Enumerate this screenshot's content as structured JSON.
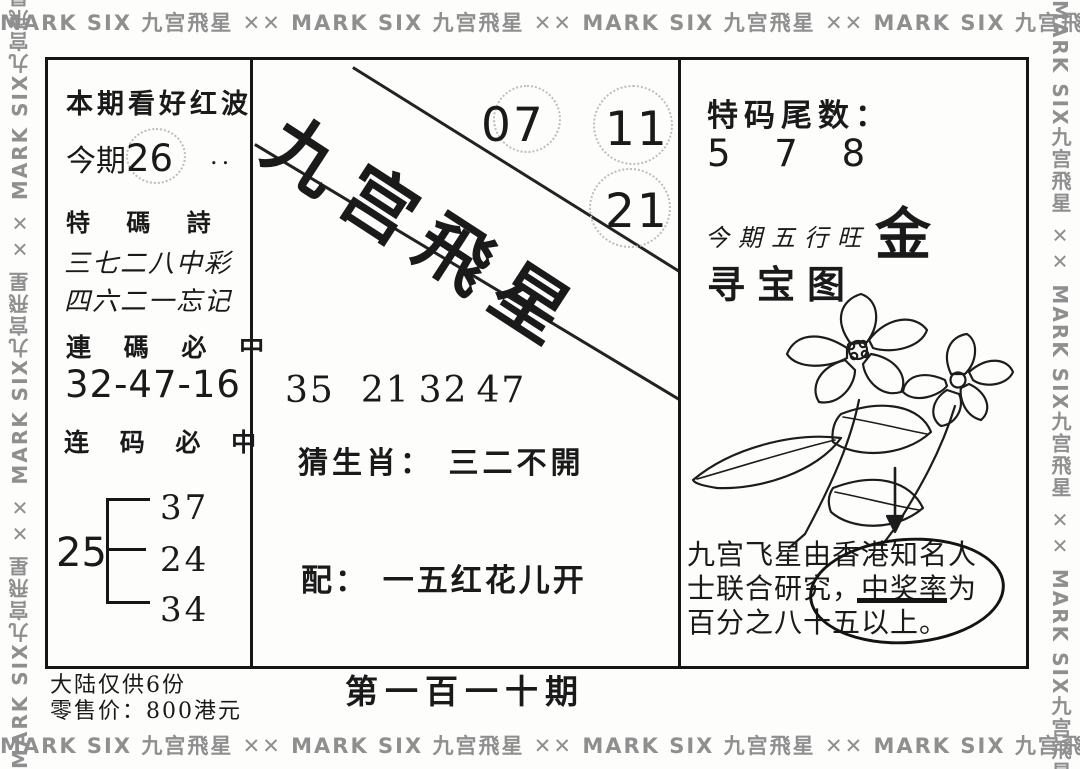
{
  "border": {
    "strip_h": "MARK SIX 九宫飛星 ✕✕ MARK SIX 九宫飛星 ✕✕ MARK SIX 九宫飛星 ✕✕ MARK SIX 九宫飛星 ✕✕",
    "strip_v": "MARK SIX九宫飛星 ✕✕ MARK SIX九宫飛星 ✕✕ MARK SIX九宫飛星 ✕✕",
    "stamp_color": "#8f8f8f"
  },
  "left_column": {
    "headline": "本期看好红波",
    "period_label": "今期",
    "period_number": "26",
    "period_dots": "..",
    "poem_title": "特 碼 詩",
    "poem_line1": "三七二八中彩",
    "poem_line2": "四六二一忘记",
    "lianma_label_trad": "連 碼 必 中",
    "lianma_numbers": "32-47-16",
    "lianma_label_simp": "连 码 必 中",
    "bracket": {
      "root": "25",
      "leaves": [
        "37",
        "24",
        "34"
      ]
    }
  },
  "middle_column": {
    "brand_calligraphy": "九宫飛星",
    "circled_numbers": [
      "07",
      "11",
      "21"
    ],
    "number_row": [
      "35",
      "21",
      "32",
      "47"
    ],
    "zodiac_label": "猜生肖：",
    "zodiac_value": "三二不開",
    "pair_label": "配：",
    "pair_value": "一五红花儿开"
  },
  "right_column": {
    "tail_label": "特码尾数：",
    "tail_numbers": "5 7 8",
    "wuxing_label": "今期五行旺",
    "wuxing_value": "金",
    "treasure_title": "寻宝图",
    "note_line1": "九宫飞星由香港知名人",
    "note_line2": "士联合研究，中奖率为",
    "note_line3": "百分之八十五以上。"
  },
  "footer": {
    "supply": "大陆仅供6份",
    "price": "零售价：800港元",
    "issue": "第一百一十期"
  },
  "colors": {
    "ink": "#1a1a1a",
    "paper": "#fdfdfc",
    "dotted_circle": "#bdbdbd"
  }
}
